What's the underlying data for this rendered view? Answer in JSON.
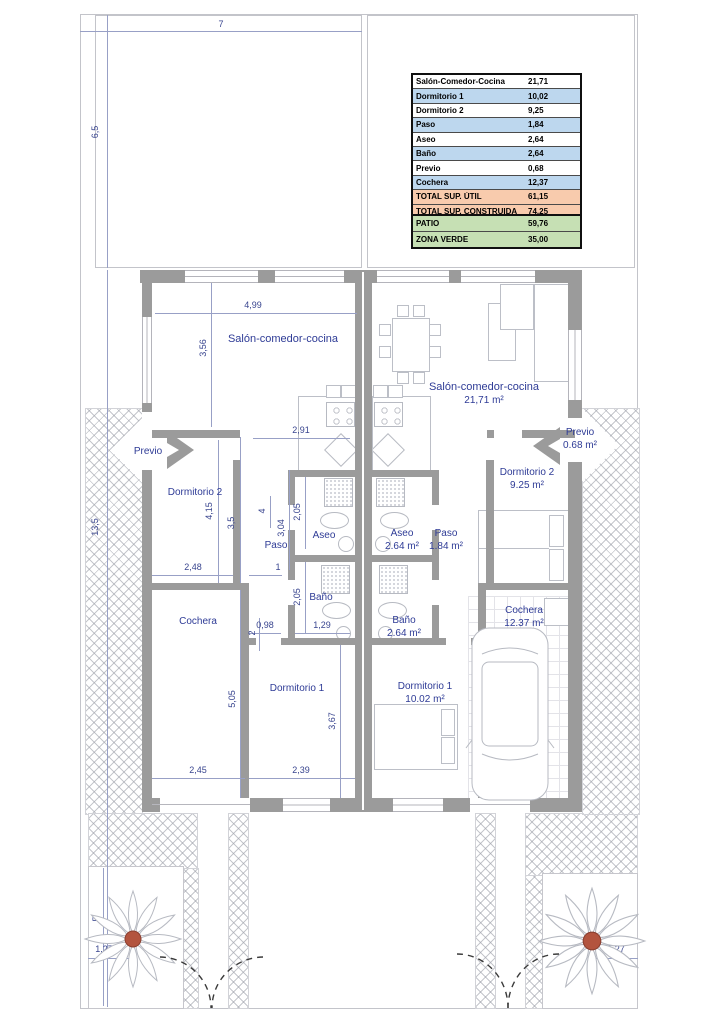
{
  "plan": {
    "summary_table": {
      "rows": [
        {
          "label": "Salón-Comedor-Cocina",
          "value": "21,71"
        },
        {
          "label": "Dormitorio 1",
          "value": "10,02"
        },
        {
          "label": "Dormitorio 2",
          "value": "9,25"
        },
        {
          "label": "Paso",
          "value": "1,84"
        },
        {
          "label": "Aseo",
          "value": "2,64"
        },
        {
          "label": "Baño",
          "value": "2,64"
        },
        {
          "label": "Previo",
          "value": "0,68"
        },
        {
          "label": "Cochera",
          "value": "12,37"
        },
        {
          "label": "TOTAL SUP. ÚTIL",
          "value": "61,15"
        },
        {
          "label": "TOTAL SUP. CONSTRUIDA",
          "value": "74,25"
        }
      ]
    },
    "outdoor_table": {
      "rows": [
        {
          "label": "PATIO",
          "value": "59,76"
        },
        {
          "label": "ZONA VERDE",
          "value": "35,00"
        }
      ]
    },
    "rooms_left": {
      "salon": "Salón-comedor-cocina",
      "previo": "Previo",
      "dormitorio2": "Dormitorio 2",
      "paso": "Paso",
      "aseo": "Aseo",
      "bano": "Baño",
      "cochera": "Cochera",
      "dormitorio1": "Dormitorio 1"
    },
    "rooms_right": {
      "salon": {
        "name": "Salón-comedor-cocina",
        "area": "21,71 m²"
      },
      "previo": {
        "name": "Previo",
        "area": "0.68 m²"
      },
      "dormitorio2": {
        "name": "Dormitorio 2",
        "area": "9.25 m²"
      },
      "paso": {
        "name": "Paso",
        "area": "1.84 m²"
      },
      "aseo": {
        "name": "Aseo",
        "area": "2.64 m²"
      },
      "bano": {
        "name": "Baño",
        "area": "2.64 m²"
      },
      "dormitorio1": {
        "name": "Dormitorio 1",
        "area": "10.02 m²"
      },
      "cochera": {
        "name": "Cochera",
        "area": "12.37 m²"
      }
    },
    "dimensions": {
      "plot_width": "7",
      "patio_height": "6,5",
      "building_height": "13,5",
      "salon_width": "4,99",
      "salon_height": "3,56",
      "kitchen_width": "2,91",
      "dorm2_height": "4,15",
      "mid_height": "3,5",
      "small_four": "4",
      "paso_height": "3,04",
      "aseo_height": "2,05",
      "bano_height": "2,05",
      "dorm2_width": "2,48",
      "paso_width": "1",
      "w098": "0,98",
      "w129": "1,29",
      "small_two": "2",
      "cochera_height": "5,05",
      "dorm1_height": "3,67",
      "cochera_width": "2,45",
      "dorm1_width": "2,39",
      "garden_height": "5",
      "garden_left_width": "1,27",
      "garden_right_width": "1,27"
    },
    "colors": {
      "row_blue": "#bdd7ee",
      "row_orange": "#f8cbad",
      "row_green": "#c6e0b4",
      "wall": "#9b9b9b",
      "label_blue": "#2e3b96",
      "plant_center": "#b3543e"
    }
  }
}
